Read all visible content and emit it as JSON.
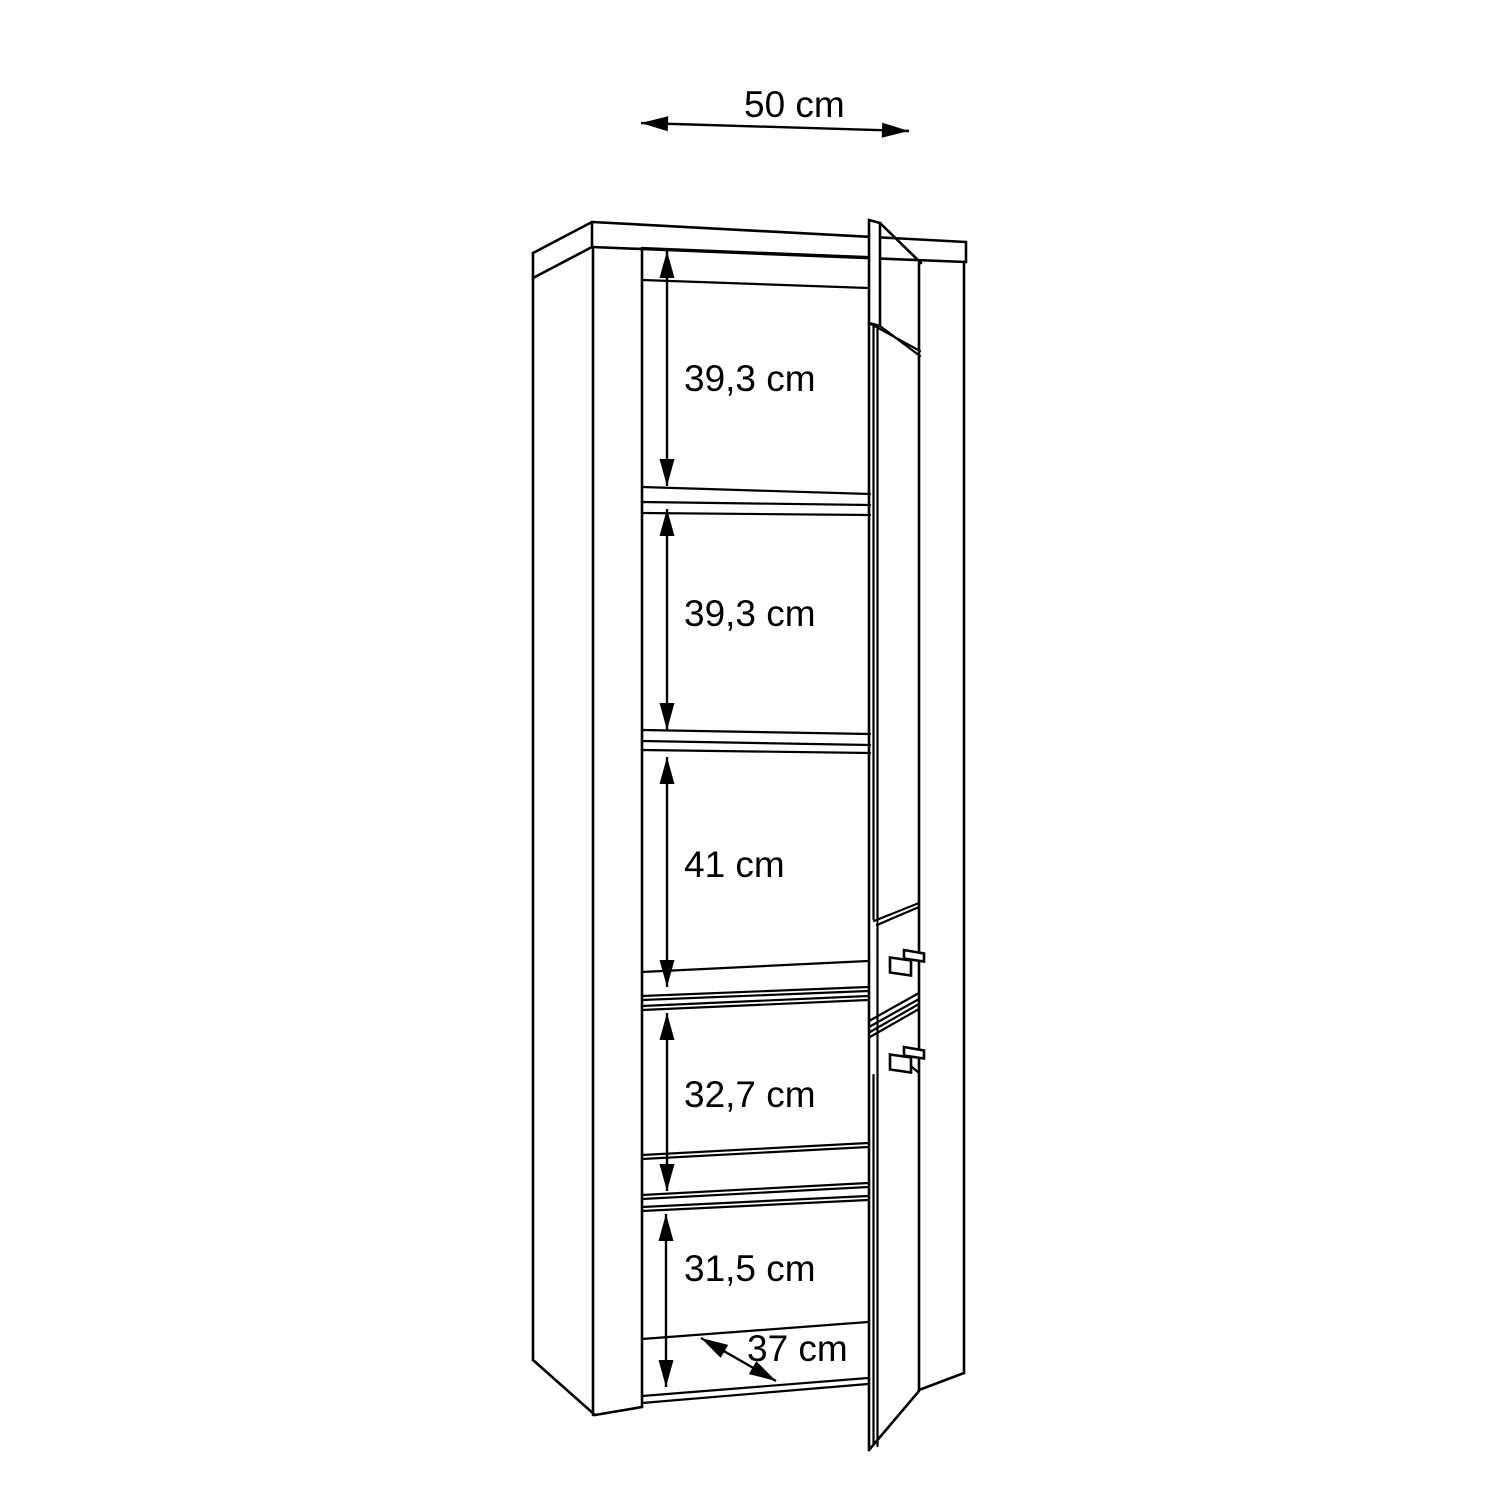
{
  "diagram": {
    "type": "furniture-dimension-drawing",
    "subject": "tall cabinet shown in perspective with right-hinged doors open and five interior compartments",
    "background": "#ffffff",
    "line_color": "#000000",
    "unit": "cm"
  },
  "dimensions": {
    "width": {
      "label": "50 cm"
    },
    "sections": [
      {
        "label": "39,3 cm"
      },
      {
        "label": "39,3 cm"
      },
      {
        "label": "41 cm"
      },
      {
        "label": "32,7 cm"
      },
      {
        "label": "31,5 cm"
      }
    ],
    "depth": {
      "label": "37 cm"
    }
  }
}
